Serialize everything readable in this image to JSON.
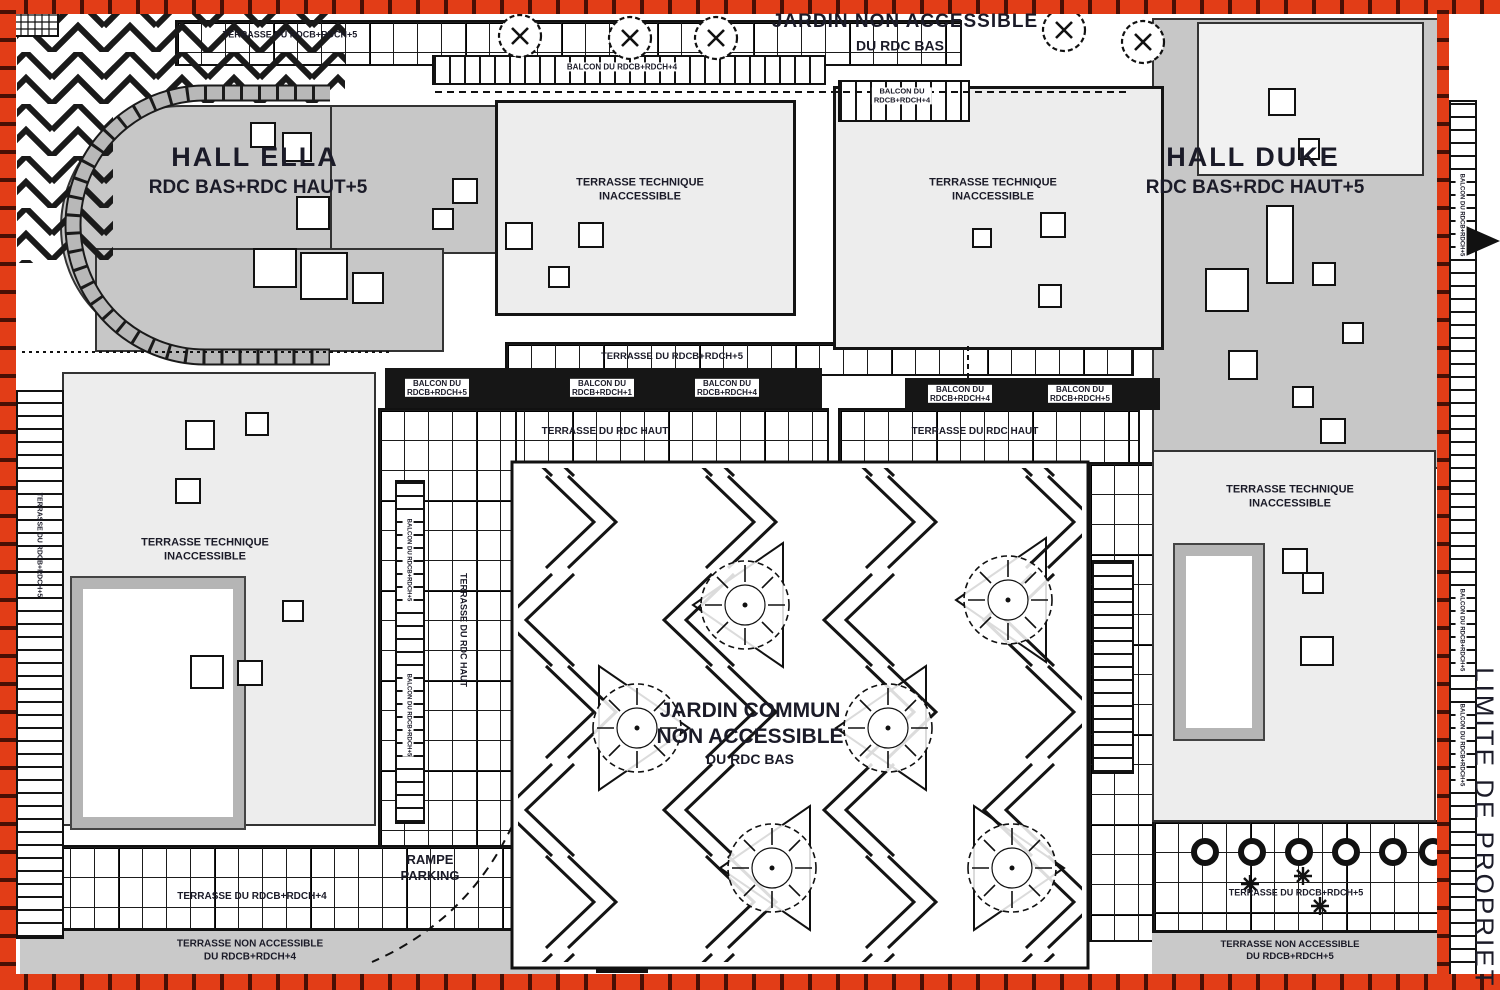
{
  "plan": {
    "halls": {
      "ella": {
        "name": "HALL ELLA",
        "levels": "RDC BAS+RDC HAUT+5"
      },
      "duke": {
        "name": "HALL DUKE",
        "levels": "RDC BAS+RDC HAUT+5"
      }
    },
    "gardens": {
      "top": {
        "line1": "JARDIN NON ACCESSIBLE",
        "line2": "DU RDC BAS"
      },
      "central": {
        "line1": "JARDIN COMMUN",
        "line2": "NON ACCESSIBLE",
        "line3": "DU RDC BAS"
      }
    },
    "terraces": {
      "technique_line1": "TERRASSE TECHNIQUE",
      "technique_line2": "INACCESSIBLE",
      "rdc_haut": "TERRASSE DU RDC HAUT",
      "rdcb_rdch5": "TERRASSE DU RDCB+RDCH+5",
      "rdcb_rdch4": "TERRASSE DU RDCB+RDCH+4",
      "non_accessible_line1": "TERRASSE NON ACCESSIBLE",
      "non_accessible_4_line2": "DU RDCB+RDCH+4",
      "non_accessible_5_line2": "DU RDCB+RDCH+5"
    },
    "balconies": {
      "du": "BALCON DU",
      "rdcb_rdch1": "RDCB+RDCH+1",
      "rdcb_rdch4": "RDCB+RDCH+4",
      "rdcb_rdch5": "RDCB+RDCH+5",
      "full4": "BALCON DU RDCB+RDCH+4",
      "full5": "BALCON DU RDCB+RDCH+5"
    },
    "parking": {
      "line1": "RAMPE",
      "line2": "PARKING"
    },
    "boundary": "LIMITE DE PROPRIETE",
    "colors": {
      "boundary_red": "#e23d17",
      "hall_gray": "#c7c7c7",
      "terrace_gray": "#ededed",
      "line_black": "#141414"
    }
  }
}
